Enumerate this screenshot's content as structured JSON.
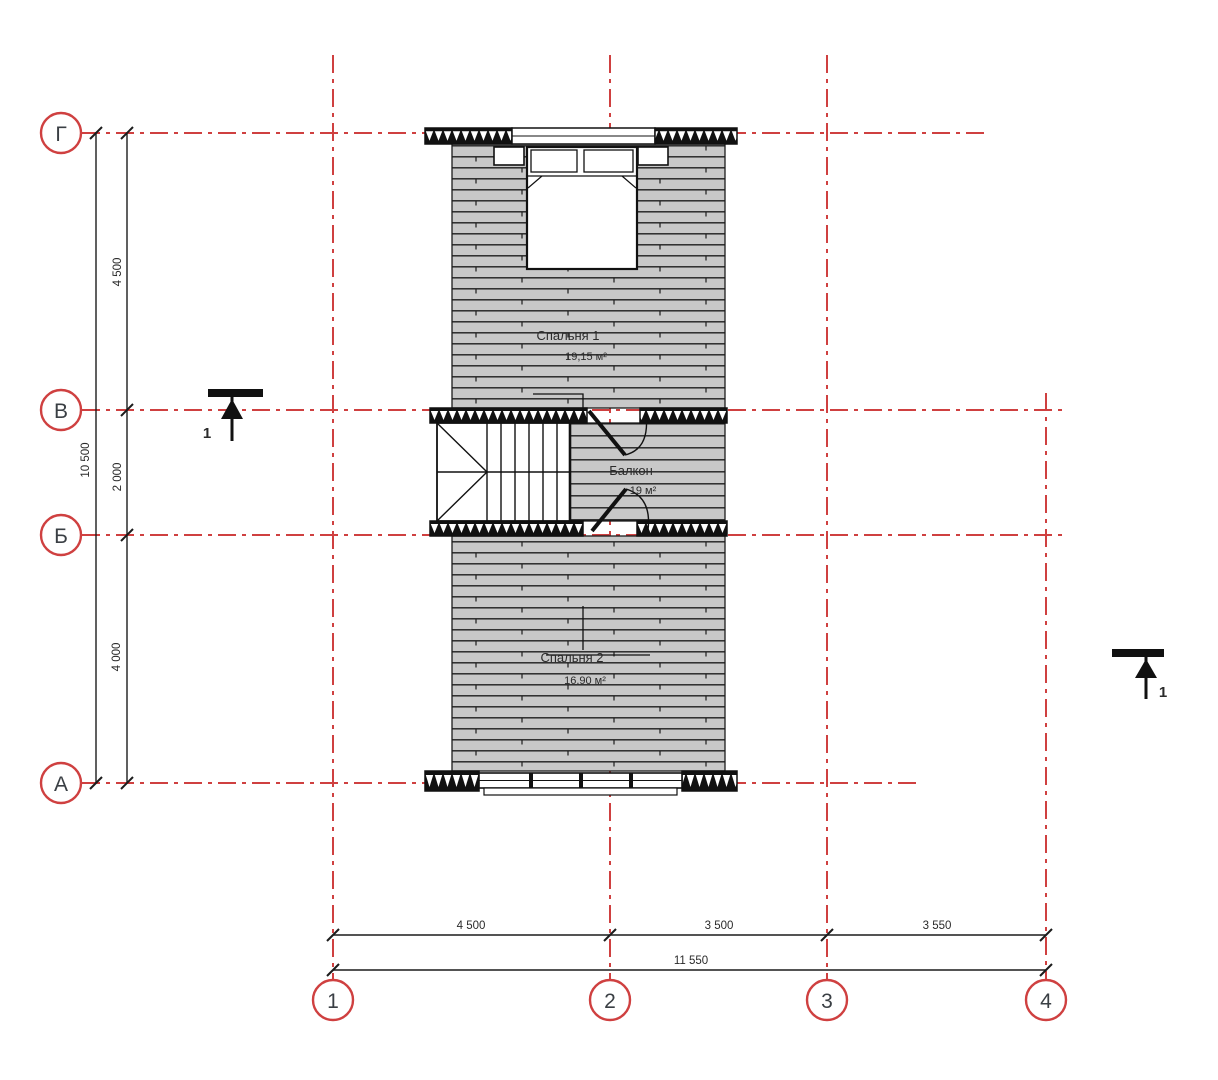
{
  "axes": {
    "rows": [
      "Г",
      "В",
      "Б",
      "А"
    ],
    "cols": [
      "1",
      "2",
      "3",
      "4"
    ]
  },
  "dimensions": {
    "left": {
      "segments": [
        "4 500",
        "2 000",
        "4 000"
      ],
      "total": "10 500"
    },
    "bottom": {
      "segments": [
        "4 500",
        "3 500",
        "3 550"
      ],
      "total": "11 550"
    }
  },
  "rooms": {
    "bedroom1": {
      "name": "Спальня 1",
      "area": "19,15 м²"
    },
    "balcony": {
      "name": "Балкон",
      "area": "19 м²"
    },
    "bedroom2": {
      "name": "Спальня 2",
      "area": "16,90 м²"
    }
  },
  "sections": {
    "left": "1",
    "right": "1"
  },
  "colors": {
    "axis_red": "#cf4040",
    "ink": "#1c1c1c",
    "floor_gray": "#c8c8c8"
  }
}
